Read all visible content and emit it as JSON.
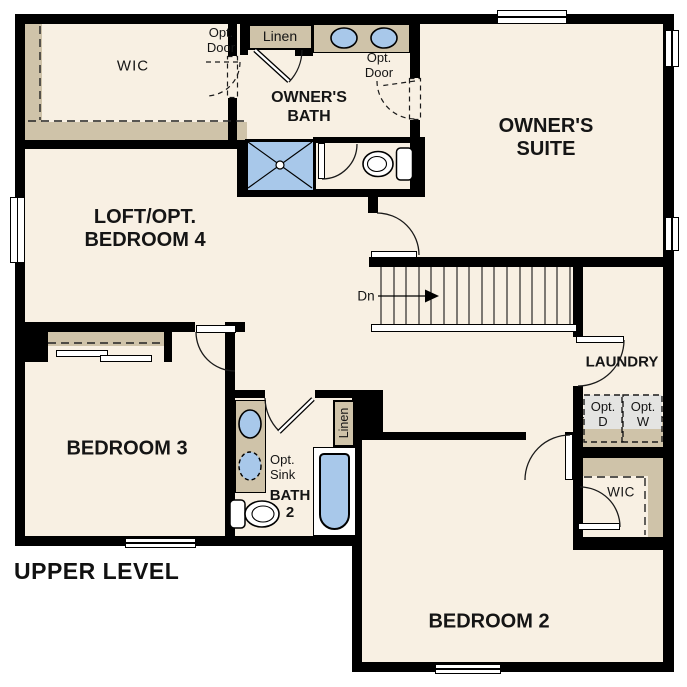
{
  "plan": {
    "level_title": "UPPER LEVEL",
    "stairs": {
      "label": "Dn"
    },
    "rooms": {
      "wic_owner": {
        "name": "WIC"
      },
      "owners_bath": {
        "line1": "OWNER'S",
        "line2": "BATH"
      },
      "owners_suite": {
        "line1": "OWNER'S",
        "line2": "SUITE"
      },
      "loft": {
        "line1": "LOFT/OPT.",
        "line2": "BEDROOM 4"
      },
      "laundry": {
        "name": "LAUNDRY"
      },
      "bedroom2": {
        "name": "BEDROOM 2"
      },
      "bedroom3": {
        "name": "BEDROOM 3"
      },
      "bath2": {
        "line1": "BATH",
        "line2": "2"
      },
      "wic_bedroom2": {
        "name": "WIC"
      }
    },
    "annotations": {
      "opt_door_wic": {
        "line1": "Opt.",
        "line2": "Door"
      },
      "opt_door_suite": {
        "line1": "Opt.",
        "line2": "Door"
      },
      "linen_owner": {
        "name": "Linen"
      },
      "linen_bath2": {
        "name": "Linen"
      },
      "opt_sink": {
        "line1": "Opt.",
        "line2": "Sink"
      },
      "opt_dryer": {
        "line1": "Opt.",
        "line2": "D"
      },
      "opt_washer": {
        "line1": "Opt.",
        "line2": "W"
      }
    },
    "colors": {
      "wall": "#000000",
      "floor": "#f8f0e3",
      "casework": "#cfc3a9",
      "fixture_blue": "#a8c8ea",
      "appliance_gray": "#e4e4e2",
      "outside": "#ffffff"
    }
  }
}
